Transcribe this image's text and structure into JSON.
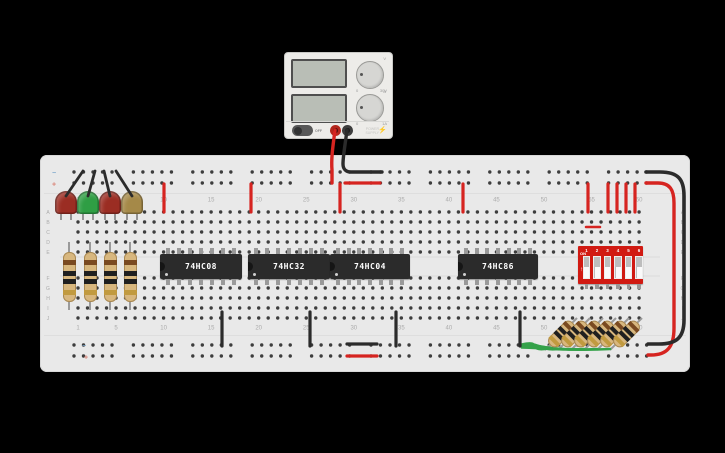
{
  "power_supply": {
    "power_button_label": "OFF",
    "brand_line1": "POWER",
    "brand_line2": "SUPPLY",
    "bolt_icon": "⚡",
    "knobs": [
      {
        "name": "voltage",
        "min": "0",
        "max": "30V",
        "unit_icon": "V"
      },
      {
        "name": "current",
        "min": "0",
        "max": "1A",
        "unit_icon": "A"
      }
    ],
    "positive_terminal_color": "#b3271d",
    "negative_terminal_color": "#3d3d3d"
  },
  "breadboard": {
    "row_letters": [
      "A",
      "B",
      "C",
      "D",
      "E",
      "F",
      "G",
      "H",
      "I",
      "J"
    ],
    "column_numbers": [
      "1",
      "5",
      "10",
      "15",
      "20",
      "25",
      "30",
      "35",
      "40",
      "45",
      "50",
      "55",
      "60"
    ],
    "minus_symbol": "−",
    "plus_symbol": "+",
    "board_color": "#e9e9e9",
    "hole_color": "#3d3d3d",
    "minus_color": "#7fa8cc",
    "plus_color": "#d98073"
  },
  "ics": [
    {
      "label": "74HC08"
    },
    {
      "label": "74HC32"
    },
    {
      "label": "74HC04"
    },
    {
      "label": "74HC86"
    }
  ],
  "dip_switch": {
    "on_label": "ON",
    "arrow_icon": "↑",
    "positions": [
      "1",
      "2",
      "3",
      "4",
      "5",
      "6"
    ],
    "body_color": "#d11a12"
  },
  "leds": [
    {
      "color_name": "red",
      "hex": "#9b2d23"
    },
    {
      "color_name": "green",
      "hex": "#2f9e44"
    },
    {
      "color_name": "red",
      "hex": "#9b2d23"
    },
    {
      "color_name": "yellow",
      "hex": "#a58948"
    }
  ],
  "resistors": {
    "body_color": "#d8b77e",
    "band_colors": [
      "#7a4a21",
      "#1f1f1f",
      "#1f1f1f",
      "#c19a3f"
    ],
    "vertical_count": 4,
    "diagonal_count": 6
  },
  "wire_colors": {
    "red": "#d62420",
    "black": "#2b2b2b",
    "green": "#35a24a",
    "lead": "#9a9a9a"
  }
}
